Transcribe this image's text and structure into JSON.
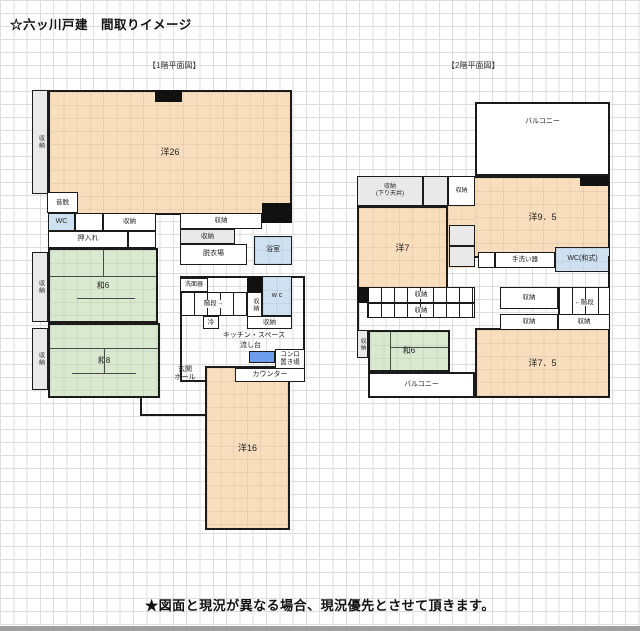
{
  "labels": {
    "title": "☆六ッ川戸建　間取りイメージ",
    "floor1_caption": "【1階平面図】",
    "floor2_caption": "【2階平面図】",
    "footer": "★図面と現況が異なる場合、現況優先とさせて頂きます。",
    "storage": "収納",
    "storage_lowered_1": "収納",
    "storage_lowered_2": "(下り天井)",
    "wc": "WC",
    "wc_small": "w c",
    "wc_washiki": "WC(和式)",
    "oshiire": "押入れ",
    "room_yo26": "洋26",
    "room_wa6": "和6",
    "room_wa8": "和8",
    "room_yo16": "洋16",
    "room_yo7": "洋7",
    "room_yo95": "洋9．5",
    "room_yo75": "洋7．5",
    "otodatsu": "音脱",
    "datsuiba": "脱衣場",
    "yokushitsu": "浴室",
    "senmenki": "洗面器",
    "stairs_right": "階段→",
    "stairs_left": "←階段",
    "rei": "冷",
    "kitchen_space": "キッチン・スペース",
    "nagashidai": "流し台",
    "konro_1": "コンロ",
    "konro_2": "置き場",
    "counter": "カウンター",
    "genkan_1": "玄関",
    "genkan_2": "ホール",
    "tearaiki": "手洗い器",
    "balcony": "バルコニー"
  },
  "colors": {
    "room_fill": "#F9DEBD",
    "tatami_fill": "#D8E9CF",
    "storage_fill": "#E9E9E9",
    "water_fill": "#CFE1F1",
    "sink_fill": "#6D9EEB",
    "wall": "#1b1b1b"
  }
}
